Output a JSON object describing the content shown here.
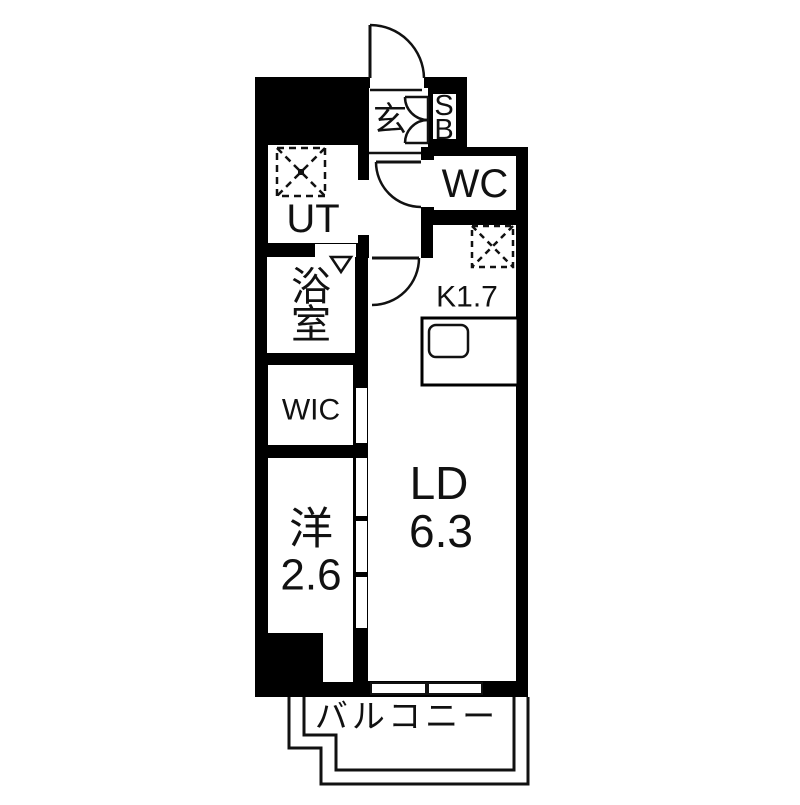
{
  "floorplan": {
    "colors": {
      "background": "#ffffff",
      "walls": "#000000",
      "lines": "#111111"
    },
    "rooms": {
      "entrance": {
        "label": "玄"
      },
      "shoe_box": {
        "line1": "S",
        "line2": "B"
      },
      "toilet": {
        "label": "WC"
      },
      "utility": {
        "label": "UT"
      },
      "bathroom": {
        "line1": "浴",
        "line2": "室"
      },
      "kitchen": {
        "label": "K1.7"
      },
      "walk_in_closet": {
        "label": "WIC"
      },
      "western_room": {
        "label": "洋",
        "size": "2.6"
      },
      "living_dining": {
        "label": "LD",
        "size": "6.3"
      },
      "balcony": {
        "label": "バルコニー"
      }
    }
  }
}
